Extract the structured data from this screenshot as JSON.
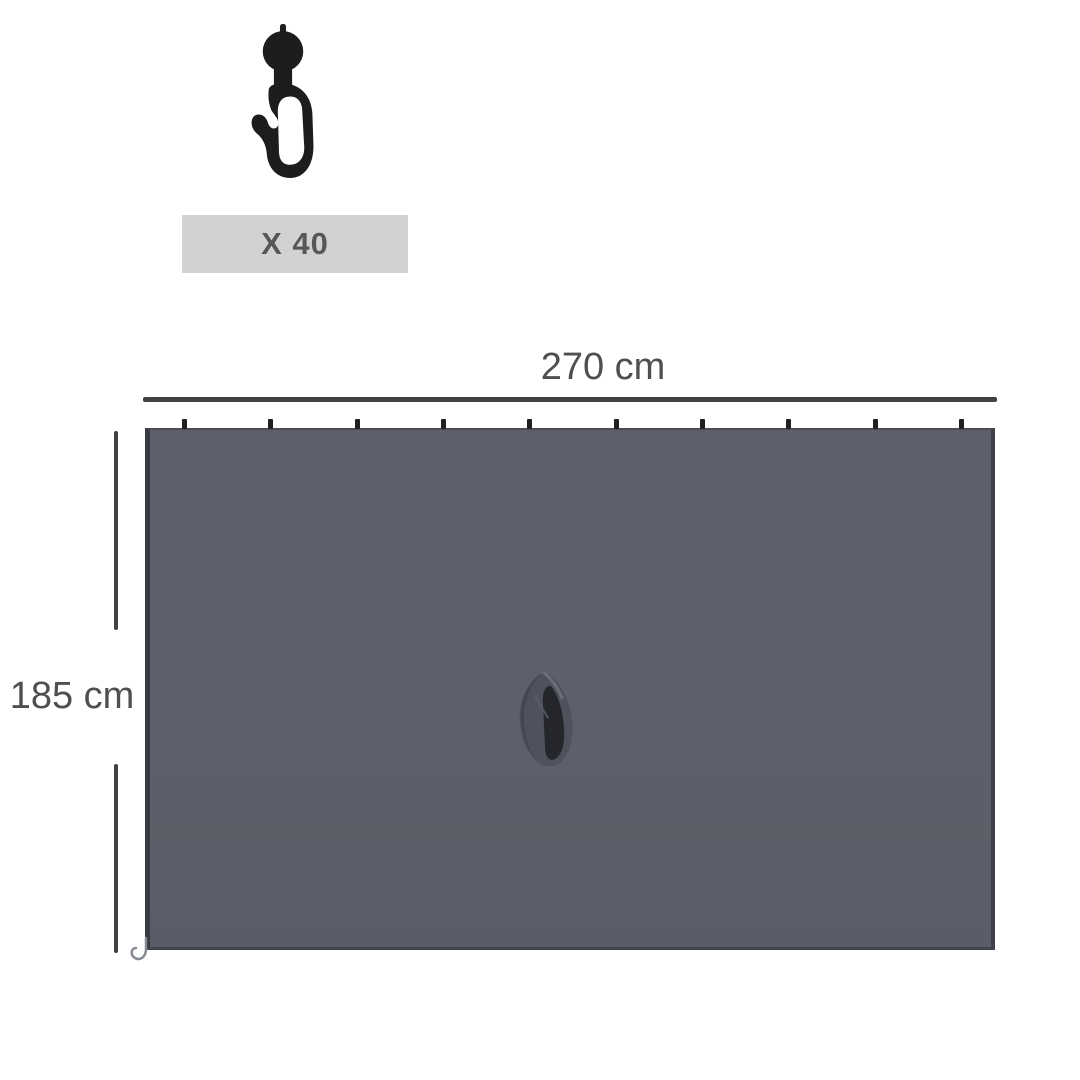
{
  "hardware": {
    "icon": "curtain-hook-icon",
    "quantity_label": "X 40"
  },
  "panel": {
    "name": "sidewall panel",
    "width_label": "270 cm",
    "height_label": "185 cm",
    "hook_tick_count": 10,
    "pocket_icon": "fabric-tie-pocket"
  },
  "colors": {
    "background": "#ffffff",
    "panel_fill": "#5d606a",
    "panel_fill_dark": "#5a5d67",
    "panel_edge": "#3b3e46",
    "dimension_line": "#424242",
    "label_text": "#4f4f4f",
    "banner_bg": "#d2d2d2",
    "banner_text": "#57575a",
    "hook_black": "#1d1d1f",
    "tick_black": "#202022"
  }
}
